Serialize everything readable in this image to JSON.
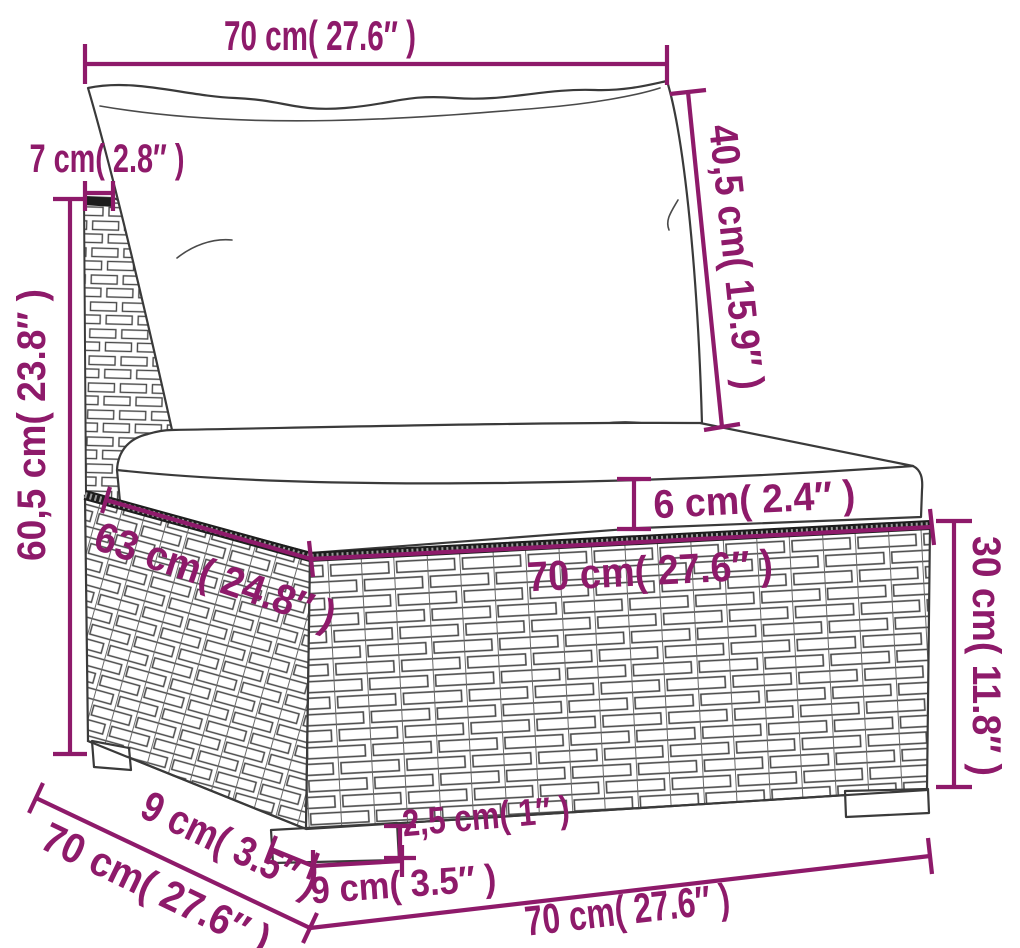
{
  "diagram": {
    "description": "Dimension diagram of a poly rattan garden sofa middle section with white cushions",
    "colors": {
      "dimension_accent": "#8e1a6a",
      "line_art": "#3a3a3a",
      "background": "#ffffff",
      "braid_strip": "#1d1d1d"
    },
    "parts": {
      "back_cushion": "back cushion",
      "seat_cushion": "seat cushion",
      "backrest": "rattan backrest",
      "base": "rattan base",
      "legs": "feet"
    },
    "dimensions": {
      "back_cushion_width": "70 cm( 27.6″ )",
      "backrest_thickness": "7 cm( 2.8″ )",
      "back_cushion_height": "40,5 cm( 15.9″ )",
      "total_height": "60,5 cm( 23.8″ )",
      "seat_cushion_thickness": "6 cm( 2.4″ )",
      "seat_depth": "63 cm( 24.8″ )",
      "seat_width": "70 cm( 27.6″ )",
      "base_height": "30 cm( 11.8″ )",
      "total_depth": "70 cm( 27.6″ )",
      "leg_depth": "9 cm( 3.5″ )",
      "leg_height": "2,5 cm( 1″ )",
      "leg_width": "9 cm( 3.5″ )",
      "total_width": "70 cm( 27.6″ )"
    }
  }
}
